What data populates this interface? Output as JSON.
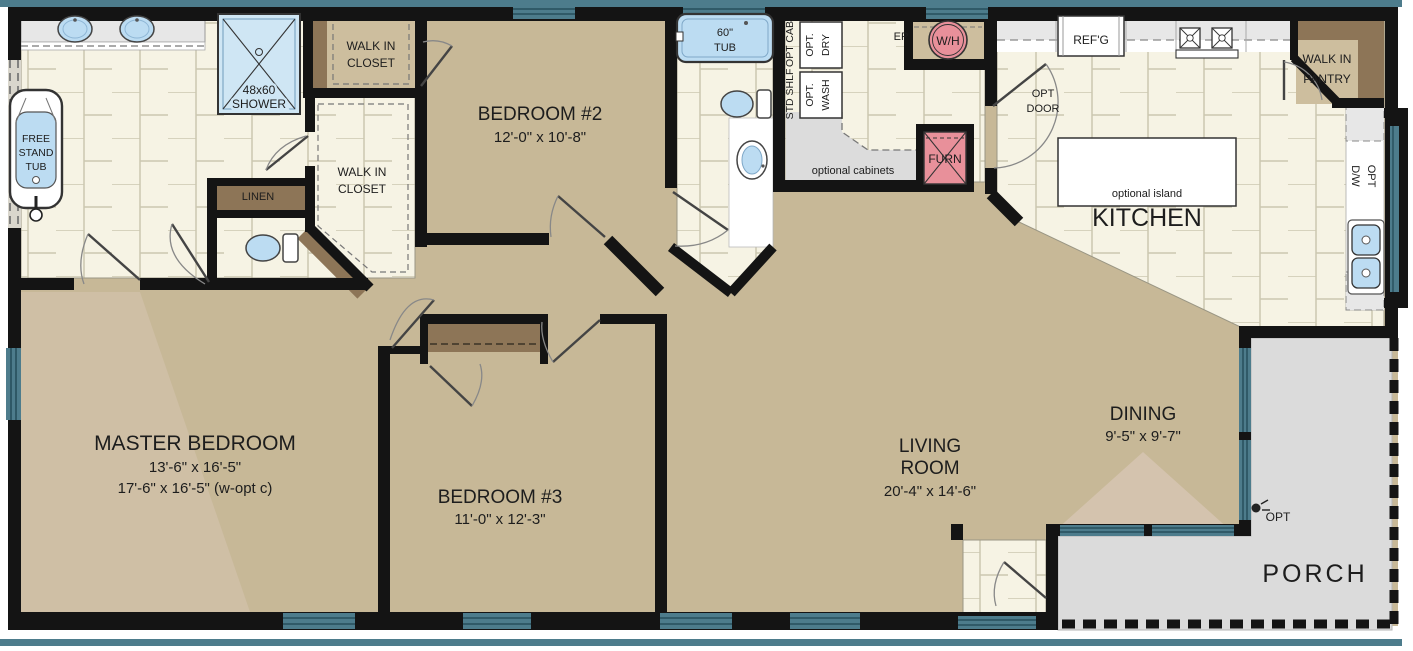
{
  "colors": {
    "wall": "#141414",
    "floor_tan": "#c7b897",
    "tile_cream": "#f6f3e4",
    "grout": "#ccc7b0",
    "porch_gray": "#dbdbdb",
    "window_teal": "#4d7c8c",
    "window_stripe": "#274f5c",
    "fixture_blue": "#bcdcf2",
    "equipment_pink": "#e8909a",
    "shelf_brown": "#8d7557",
    "closet_tan": "#cdbe9e",
    "counter_gray": "#e7e7e7"
  },
  "rooms": {
    "master_bedroom": {
      "name": "MASTER BEDROOM",
      "dim_standard": "13'-6\" x 16'-5\"",
      "dim_optional": "17'-6\" x 16'-5\" (w-opt c)"
    },
    "bedroom_2": {
      "name": "BEDROOM #2",
      "dim": "12'-0\" x 10'-8\""
    },
    "bedroom_3": {
      "name": "BEDROOM #3",
      "dim": "11'-0\" x 12'-3\""
    },
    "living_room": {
      "name_line1": "LIVING",
      "name_line2": "ROOM",
      "dim": "20'-4\" x 14'-6\""
    },
    "dining": {
      "name": "DINING",
      "dim": "9'-5\" x 9'-7\""
    },
    "kitchen": {
      "name": "KITCHEN",
      "island": "optional island",
      "fridge": "REF'G",
      "dw_line1": "OPT",
      "dw_line2": "D/W",
      "pantry_line1": "WALK IN",
      "pantry_line2": "PANTRY"
    },
    "porch": {
      "name": "PORCH",
      "opt": "OPT"
    }
  },
  "master_bath": {
    "tub_line1": "FREE",
    "tub_line2": "STAND",
    "tub_line3": "TUB",
    "shower_line1": "48x60",
    "shower_line2": "SHOWER",
    "closet_top_line1": "WALK IN",
    "closet_top_line2": "CLOSET",
    "closet_main_line1": "WALK IN",
    "closet_main_line2": "CLOSET",
    "linen": "LINEN"
  },
  "bath_2": {
    "tub_line1": "60\"",
    "tub_line2": "TUB"
  },
  "utility": {
    "opt_cab": "OPT CAB",
    "std_shlf": "STD SHLF",
    "dry_line1": "OPT.",
    "dry_line2": "DRY",
    "wash_line1": "OPT.",
    "wash_line2": "WASH",
    "ep": "EP",
    "water_heater": "W/H",
    "furnace": "FURN",
    "opt_door_line1": "OPT",
    "opt_door_line2": "DOOR",
    "optional_cabinets": "optional cabinets"
  }
}
